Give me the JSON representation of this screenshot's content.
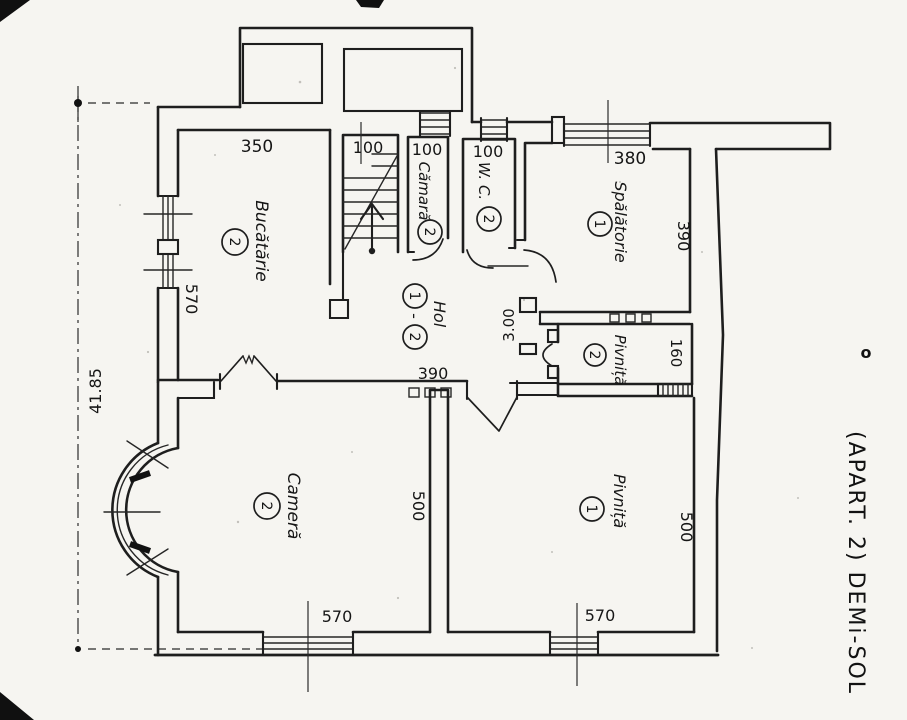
{
  "meta": {
    "side_title": "(APART. 2) DEMi-SOL",
    "side_mark": "o",
    "ink_color": "#1e1e1e",
    "paper_color": "#f6f5f1"
  },
  "rooms": {
    "bucatarie": {
      "label": "Bucătărie",
      "number": "2"
    },
    "camara": {
      "label": "Cămară",
      "number": "2"
    },
    "wc": {
      "label": "W. C.",
      "number": "2"
    },
    "spalatorie": {
      "label": "Spălătorie",
      "number": "1"
    },
    "hol": {
      "label": "Hol",
      "number_top": "1",
      "separator": "-",
      "number_bottom": "2"
    },
    "pivnita_2": {
      "label": "Pivniță",
      "number": "2"
    },
    "pivnita_1": {
      "label": "Pivniță",
      "number": "1"
    },
    "camera": {
      "label": "Cameră",
      "number": "2"
    }
  },
  "dimensions": {
    "bucatarie_top": "350",
    "scara_top": "100",
    "camara_top": "100",
    "wc_top": "100",
    "spalatorie_top": "380",
    "bucatarie_left": "570",
    "spalatorie_right": "390",
    "hol_passage": "3.00",
    "pivnita_2_right": "160",
    "hol_south": "390",
    "camera_right": "500",
    "pivnita_1_right": "500",
    "camera_bottom": "570",
    "pivnita_1_bottom": "570",
    "site_left": "41.85"
  }
}
